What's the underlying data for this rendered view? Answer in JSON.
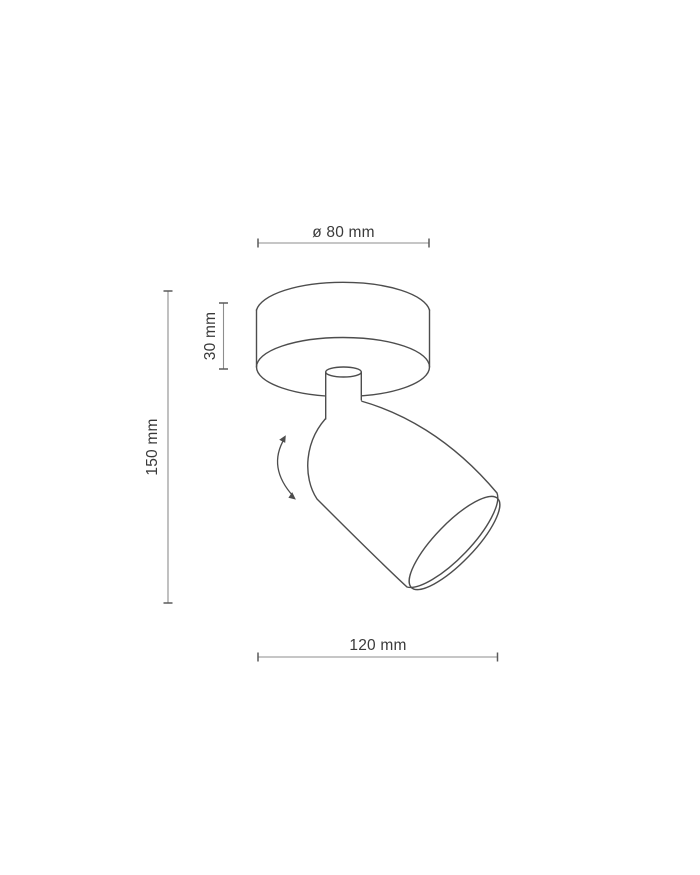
{
  "drawing": {
    "type": "technical-dimension-diagram",
    "subject": "adjustable ceiling spotlight fixture with round canopy and swivel cylinder head",
    "dimensions": {
      "diameter_label": "ø 80 mm",
      "canopy_height_label": "30 mm",
      "overall_height_label": "150 mm",
      "overall_length_label": "120 mm"
    },
    "colors": {
      "background": "#ffffff",
      "outline": "#4d4d4d",
      "dimension_line": "#8e8e8e",
      "tick": "#5a5a5a",
      "text": "#3a3a3a"
    }
  }
}
